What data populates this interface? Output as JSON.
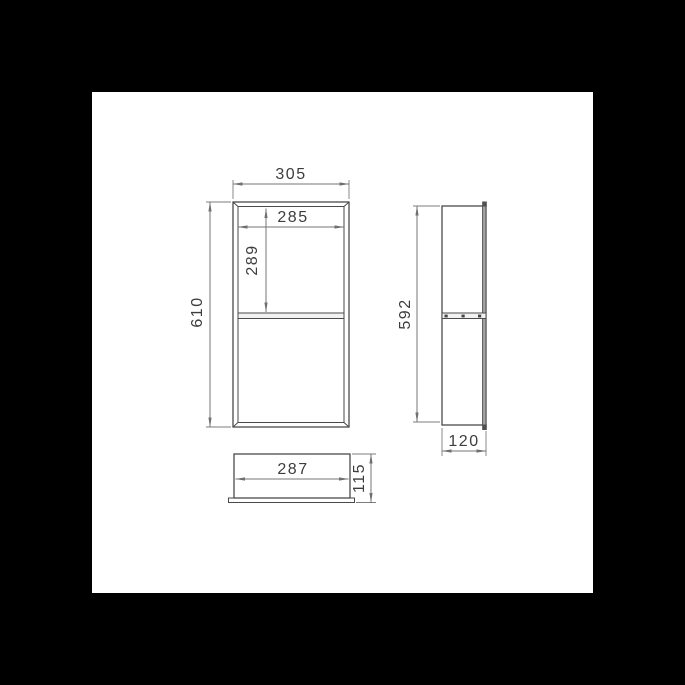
{
  "drawing": {
    "colors": {
      "background": "#000000",
      "paper": "#ffffff",
      "geometry_line": "#4a4a4a",
      "dimension_line": "#757575",
      "label_text": "#3d3d3d"
    },
    "front_view": {
      "overall_width": "305",
      "overall_height": "610",
      "inner_width": "285",
      "upper_opening_height": "289"
    },
    "side_view": {
      "body_height": "592",
      "depth": "120"
    },
    "bottom_view": {
      "inner_width": "287",
      "depth": "115"
    }
  }
}
